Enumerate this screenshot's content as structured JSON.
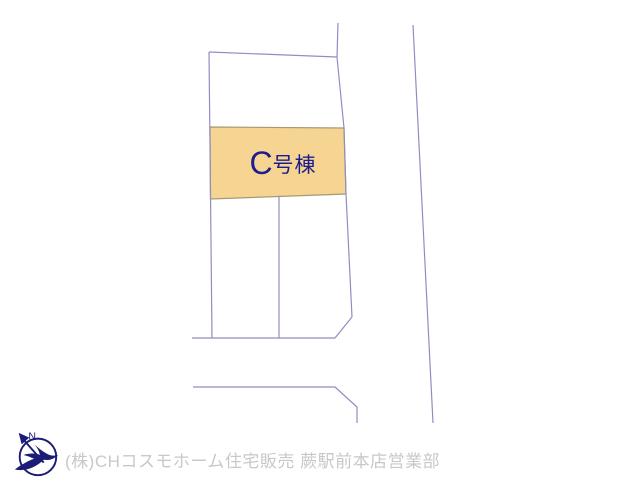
{
  "site_plan": {
    "line_color": "#908ec0",
    "highlighted_lot": {
      "label": "C号棟",
      "label_prefix": "C",
      "label_suffix": "号棟",
      "fill": "#f6d492",
      "label_color": "#1d1d8e"
    }
  },
  "watermark": {
    "company_line": "(株)CHコスモホーム住宅販売 蕨駅前本店営業部",
    "text_color": "#c8c8c8",
    "logo": {
      "name": "compass-bird-logo",
      "color": "#1b1b78",
      "letter": "N"
    }
  }
}
